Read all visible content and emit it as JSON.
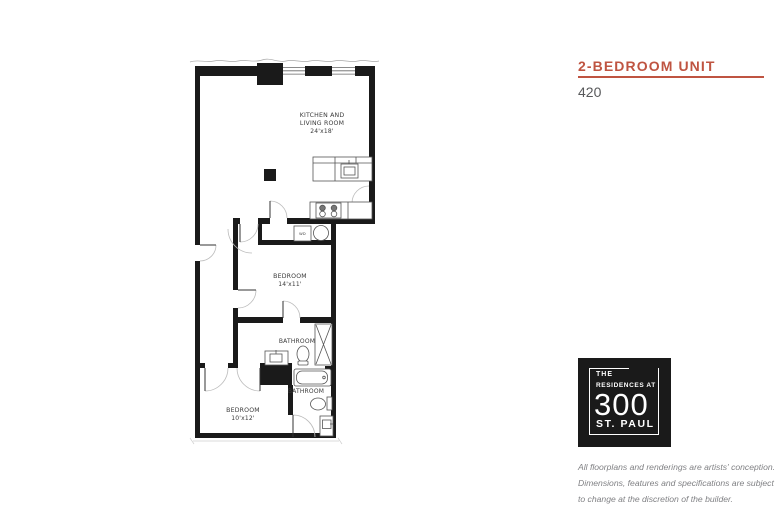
{
  "panel": {
    "title": "2-BEDROOM UNIT",
    "unit_number": "420",
    "disclaimer_lines": [
      "All floorplans and renderings are artists' conception.",
      "Dimensions, features and specifications are subject",
      "to change at the discretion of the builder."
    ]
  },
  "logo": {
    "line1": "THE",
    "line2": "RESIDENCES AT",
    "number": "300",
    "line3": "ST. PAUL"
  },
  "floorplan": {
    "rooms": {
      "kitchen_living": {
        "name_line1": "KITCHEN AND",
        "name_line2": "LIVING ROOM",
        "dimensions": "24'x18'"
      },
      "bedroom_main": {
        "name": "BEDROOM",
        "dimensions": "14'x11'"
      },
      "bathroom_upper": {
        "name": "BATHROOM"
      },
      "bedroom_second": {
        "name": "BEDROOM",
        "dimensions": "10'x12'"
      },
      "bathroom_lower": {
        "name": "BATHROOM"
      },
      "laundry": {
        "label": "WD"
      }
    }
  },
  "colors": {
    "accent_red": "#bf5441",
    "unit_number_gray": "#58595b",
    "disclaimer_gray": "#808184",
    "logo_background": "#1a1a1a",
    "wall_black": "#1a1a1a"
  }
}
